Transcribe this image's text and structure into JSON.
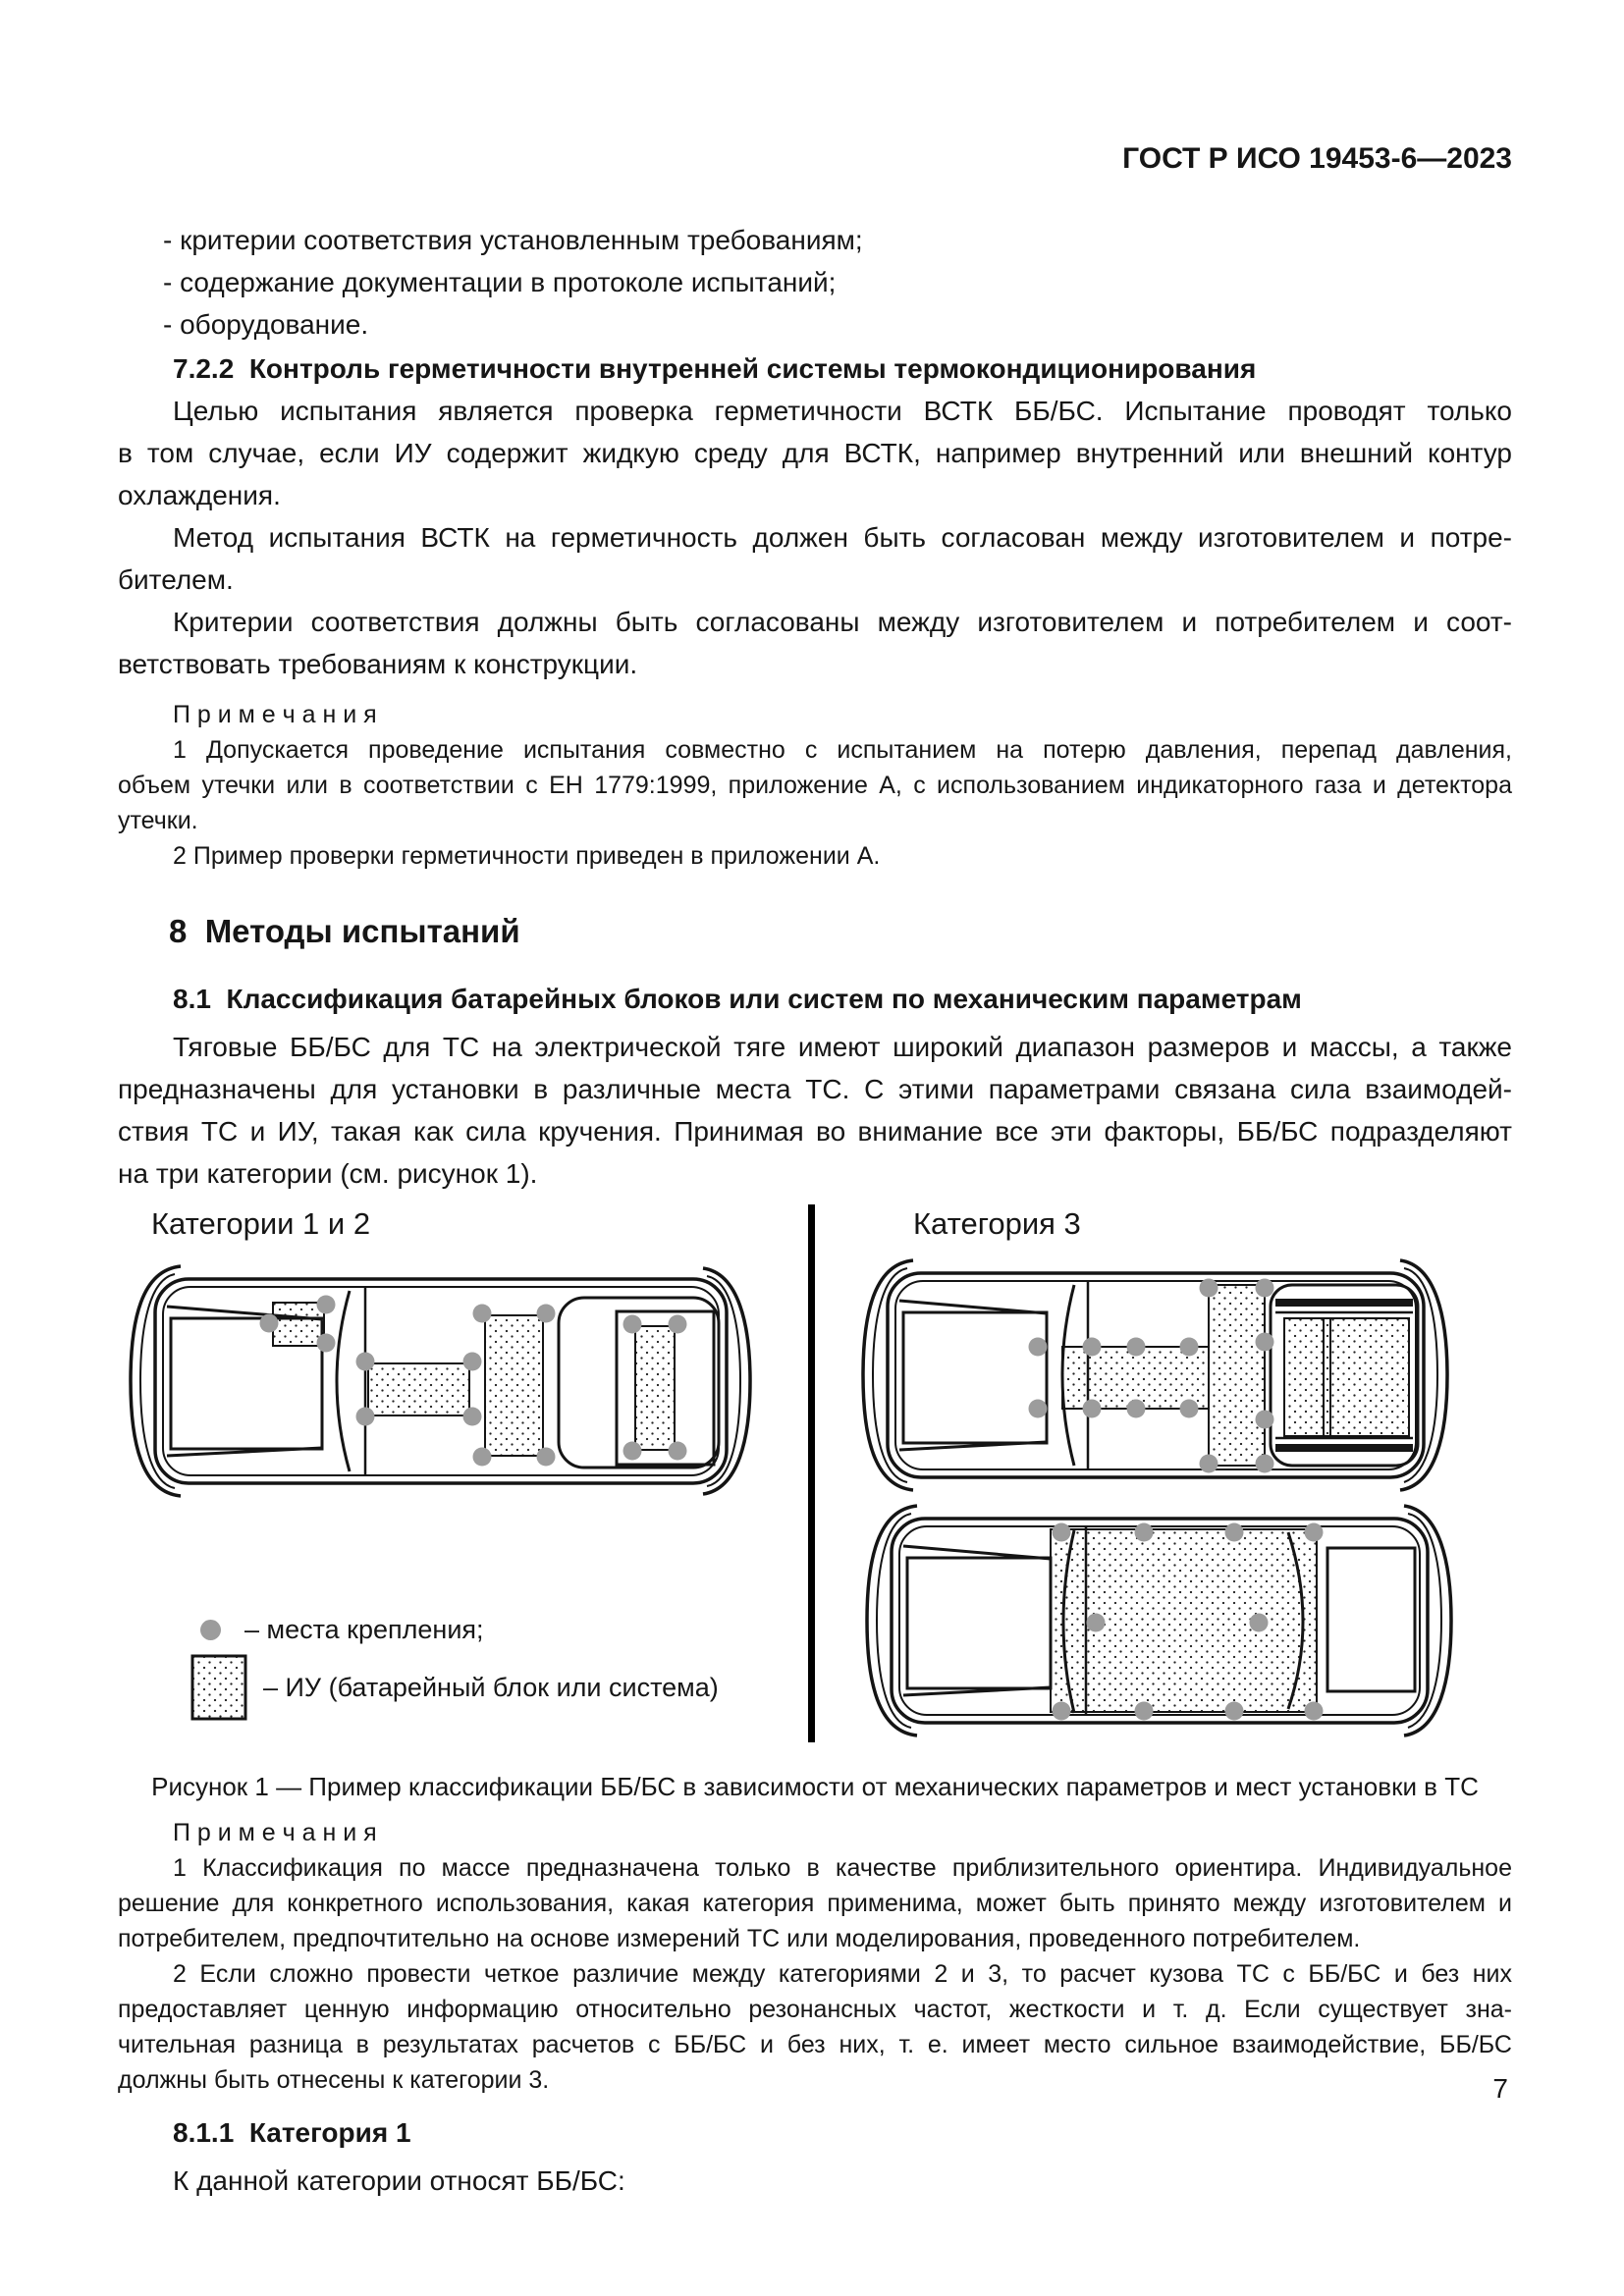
{
  "header": {
    "doc_number": "ГОСТ Р ИСО 19453-6—2023"
  },
  "list": {
    "items": [
      "- критерии соответствия установленным требованиям;",
      "- содержание документации в протоколе испытаний;",
      "- оборудование."
    ]
  },
  "section_722": {
    "heading": "7.2.2  Контроль герметичности внутренней системы термокондиционирования",
    "para1_lines": [
      "Целью испытания является проверка герметичности ВСТК ББ/БС. Испытание проводят только",
      "в том случае, если ИУ содержит жидкую среду для ВСТК, например внутренний или внешний контур",
      "охлаждения."
    ],
    "para2_lines": [
      "Метод испытания ВСТК на герметичность должен быть согласован между изготовителем и потре-",
      "бителем."
    ],
    "para3_lines": [
      "Критерии соответствия должны быть согласованы между изготовителем и потребителем и соот-",
      "ветствовать требованиям к конструкции."
    ]
  },
  "notes_thermal": {
    "title": "П р и м е ч а н и я",
    "note1_lines": [
      "1 Допускается проведение испытания совместно с испытанием на потерю давления, перепад давления,",
      "объем утечки или в соответствии с ЕН 1779:1999, приложение А, с использованием индикаторного газа и детектора",
      "утечки."
    ],
    "note2": "2 Пример проверки герметичности приведен в приложении А."
  },
  "section_8": {
    "heading": "8  Методы испытаний"
  },
  "section_81": {
    "heading": "8.1  Классификация батарейных блоков или систем по механическим параметрам",
    "para_lines": [
      "Тяговые ББ/БС для ТС на электрической тяге имеют широкий диапазон размеров и массы, а также",
      "предназначены для установки в различные места ТС. С этими параметрами связана сила взаимодей-",
      "ствия ТС и ИУ, такая как сила кручения. Принимая во внимание все эти факторы, ББ/БС подразделяют",
      "на три категории (см. рисунок 1)."
    ]
  },
  "figure": {
    "left_label": "Категории 1 и 2",
    "right_label": "Категория 3",
    "legend_dot": "– места крепления;",
    "legend_square": "– ИУ (батарейный блок или система)",
    "caption": "Рисунок 1 — Пример классификации ББ/БС в зависимости от механических параметров и мест установки в ТС",
    "mount_dot_color": "#9c9c9c"
  },
  "notes_figure": {
    "title": "П р и м е ч а н и я",
    "note1_lines": [
      "1 Классификация по массе предназначена только в качестве приблизительного ориентира. Индивидуальное",
      "решение для конкретного использования, какая категория применима, может быть принято между изготовителем и",
      "потребителем, предпочтительно на основе измерений ТС или моделирования, проведенного потребителем."
    ],
    "note2_lines": [
      "2 Если сложно провести четкое различие между категориями 2 и 3, то расчет кузова ТС с ББ/БС и без них",
      "предоставляет ценную информацию относительно резонансных частот, жесткости и т. д. Если существует зна-",
      "чительная разница в результатах расчетов с ББ/БС и без них, т. е. имеет место сильное взаимодействие, ББ/БС",
      "должны быть отнесены к категории 3."
    ]
  },
  "section_811": {
    "heading": "8.1.1  Категория 1",
    "intro": "К данной категории относят ББ/БС:"
  },
  "footer": {
    "page_number": "7"
  }
}
